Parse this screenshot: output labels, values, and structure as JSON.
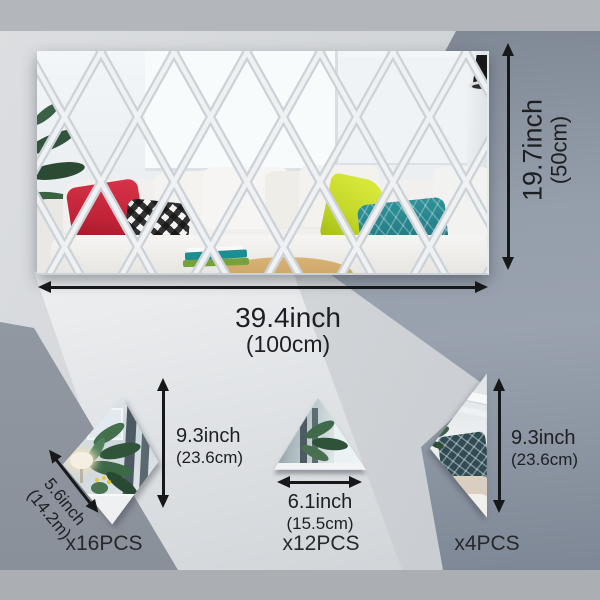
{
  "panel": {
    "width_in": "39.4inch",
    "width_cm": "(100cm)",
    "height_in": "19.7inch",
    "height_cm": "(50cm)"
  },
  "rhombus": {
    "height_in": "9.3inch",
    "height_cm": "(23.6cm)",
    "side_in": "5.6inch",
    "side_cm": "(14.2m)",
    "count": "x16PCS"
  },
  "triangle": {
    "base_in": "6.1inch",
    "base_cm": "(15.5cm)",
    "count": "x12PCS"
  },
  "half_diamond": {
    "height_in": "9.3inch",
    "height_cm": "(23.6cm)",
    "count": "x4PCS"
  },
  "icons": {
    "dimension_arrow": "double-headed-arrow"
  },
  "colors": {
    "arrow": "#17181a",
    "text": "#1d1f22",
    "top_strip": "#b3b6bb",
    "bottom_strip": "#abaeb3",
    "light_band": "#f2f3f5",
    "right_facet": "#8b94a1",
    "mirror_grid_line": "#e6e9ec",
    "pillow_red": "#c02236",
    "pillow_yellow": "#c4d829",
    "pillow_teal": "#27858e"
  }
}
